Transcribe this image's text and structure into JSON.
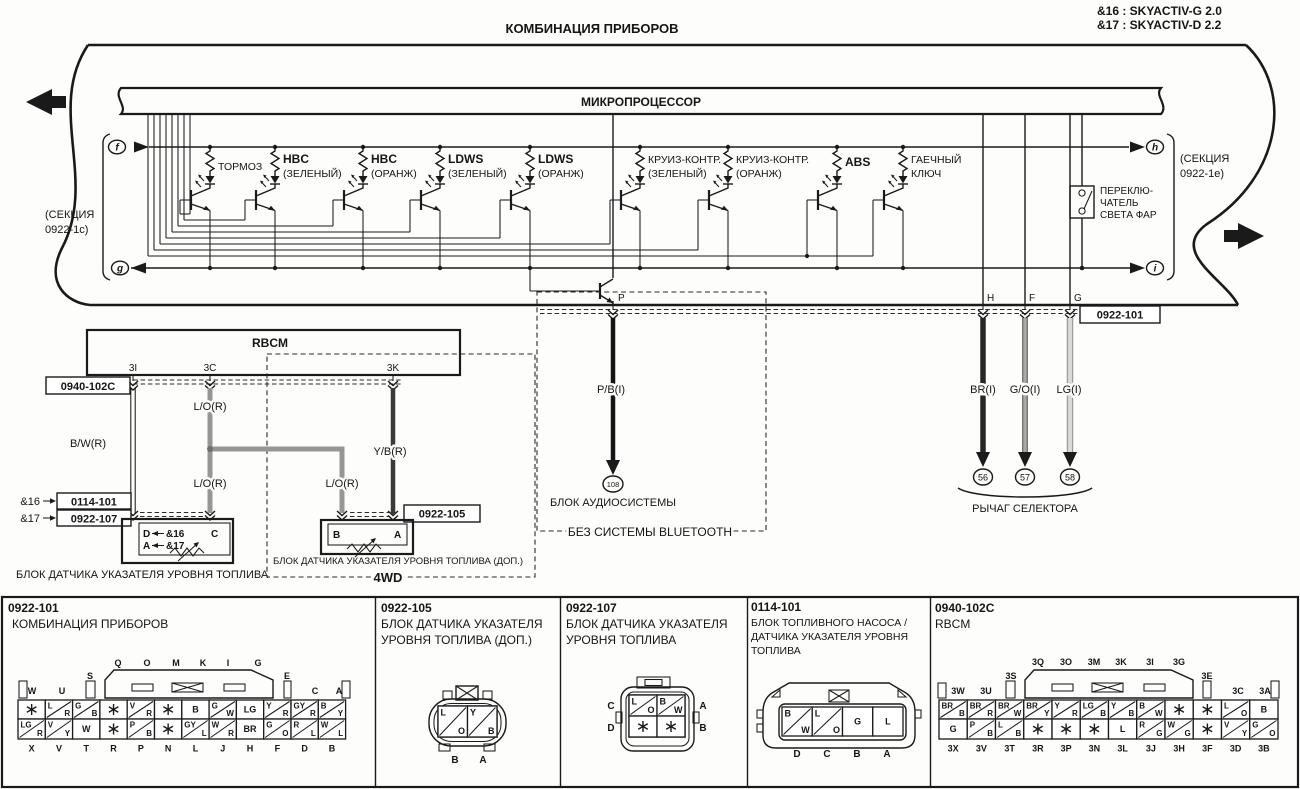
{
  "meta": {
    "variant_notes": [
      "&16 : SKYACTIV-G 2.0",
      "&17 : SKYACTIV-D 2.2"
    ]
  },
  "title": "КОМБИНАЦИЯ ПРИБОРОВ",
  "band": {
    "micro": "МИКРОПРОЦЕССОР",
    "section_left": {
      "l1": "(СЕКЦИЯ",
      "l2": "0922-1c)"
    },
    "section_right": {
      "l1": "(СЕКЦИЯ",
      "l2": "0922-1e)"
    },
    "ports": {
      "f": "f",
      "g": "g",
      "h": "h",
      "i": "i"
    },
    "indicators": [
      {
        "name": "ТОРМОЗ",
        "sub": "",
        "bold": false
      },
      {
        "name": "HBC",
        "sub": "(ЗЕЛЕНЫЙ)",
        "bold": true
      },
      {
        "name": "HBC",
        "sub": "(ОРАНЖ)",
        "bold": true
      },
      {
        "name": "LDWS",
        "sub": "(ЗЕЛЕНЫЙ)",
        "bold": true
      },
      {
        "name": "LDWS",
        "sub": "(ОРАНЖ)",
        "bold": true
      },
      {
        "name": "КРУИЗ-КОНТР.",
        "sub": "(ЗЕЛЕНЫЙ)",
        "bold": false
      },
      {
        "name": "КРУИЗ-КОНТР.",
        "sub": "(ОРАНЖ)",
        "bold": false
      },
      {
        "name": "ABS",
        "sub": "",
        "bold": true
      },
      {
        "name": "ГАЕЧНЫЙ",
        "sub": "КЛЮЧ",
        "bold": false
      }
    ],
    "headlight_switch": {
      "l1": "ПЕРЕКЛЮ-",
      "l2": "ЧАТЕЛЬ",
      "l3": "СВЕТА ФАР"
    },
    "bottom_pins": [
      "P",
      "H",
      "F",
      "G"
    ]
  },
  "rbcm": {
    "title": "RBCM",
    "pins": [
      "3I",
      "3C",
      "3K"
    ],
    "connector_ref": "0940-102C"
  },
  "wires": {
    "bw": "B/W(R)",
    "lo": "L/O(R)",
    "yb": "Y/B(R)",
    "pb": "P/B(I)",
    "br": "BR(I)",
    "go": "G/O(I)",
    "lg": "LG(I)"
  },
  "refs": {
    "amp16": "&16",
    "amp17": "&17",
    "ref16": "0114-101",
    "ref17": "0922-107"
  },
  "sender1": {
    "label": "БЛОК ДАТЧИКА УКАЗАТЕЛЯ УРОВНЯ ТОПЛИВА",
    "pin_d": "D",
    "pin_a": "A",
    "pin_c": "C"
  },
  "sender2": {
    "label": "БЛОК ДАТЧИКА УКАЗАТЕЛЯ УРОВНЯ ТОПЛИВА (ДОП.)",
    "connector_ref": "0922-105",
    "pin_b": "B",
    "pin_a": "A",
    "group": "4WD"
  },
  "audio": {
    "label": "БЛОК АУДИОСИСТЕМЫ",
    "terminal": "108",
    "note": "БЕЗ СИСТЕМЫ BLUETOOTH"
  },
  "selector": {
    "label": "РЫЧАГ СЕЛЕКТОРА",
    "terminals": [
      "56",
      "57",
      "58"
    ],
    "connector_ref": "0922-101"
  },
  "panels": [
    {
      "id": "0922-101",
      "name": [
        "КОМБИНАЦИЯ ПРИБОРОВ"
      ],
      "top_letters": [
        "W",
        "U",
        "S"
      ],
      "housing_letters": [
        "Q",
        "O",
        "M",
        "K",
        "I",
        "G"
      ],
      "right_letters": [
        "E",
        "C",
        "A"
      ],
      "row1": [
        "*",
        "L|R",
        "G|B",
        "*",
        "V|R",
        "*",
        "B",
        "G|W",
        "LG",
        "Y|R",
        "GY|R",
        "B|Y"
      ],
      "row2": [
        "LG|R",
        "V|Y",
        "W",
        "*",
        "P|B",
        "*",
        "GY|L",
        "W|R",
        "BR",
        "G|O",
        "R|L",
        "W|L"
      ],
      "bottom_letters": [
        "X",
        "V",
        "T",
        "R",
        "P",
        "N",
        "L",
        "J",
        "H",
        "F",
        "D",
        "B"
      ]
    },
    {
      "id": "0922-105",
      "name": [
        "БЛОК ДАТЧИКА УКАЗАТЕЛЯ",
        "УРОВНЯ ТОПЛИВА (ДОП.)"
      ],
      "cells": [
        "L|O",
        "Y|B"
      ],
      "pin_letters": [
        "B",
        "A"
      ]
    },
    {
      "id": "0922-107",
      "name": [
        "БЛОК ДАТЧИКА УКАЗАТЕЛЯ",
        "УРОВНЯ ТОПЛИВА"
      ],
      "cells_top": [
        "L|O",
        "B|W"
      ],
      "cells_bottom": [
        "*",
        "*"
      ],
      "left_letters": [
        "C",
        "D"
      ],
      "right_letters": [
        "A",
        "B"
      ]
    },
    {
      "id": "0114-101",
      "name": [
        "БЛОК ТОПЛИВНОГО НАСОСА /",
        "ДАТЧИКА УКАЗАТЕЛЯ УРОВНЯ",
        "ТОПЛИВА"
      ],
      "cells": [
        "B|W",
        "L|O",
        "G",
        "L"
      ],
      "pin_letters": [
        "D",
        "C",
        "B",
        "A"
      ]
    },
    {
      "id": "0940-102C",
      "name": [
        "RBCM"
      ],
      "top_letters": [
        "3W",
        "3U",
        "3S"
      ],
      "housing_letters": [
        "3Q",
        "3O",
        "3M",
        "3K",
        "3I",
        "3G"
      ],
      "right_letters": [
        "3E",
        "3C",
        "3A"
      ],
      "row1": [
        "BR|B",
        "BR|R",
        "BR|W",
        "BR|Y",
        "Y|R",
        "LG|B",
        "Y|B",
        "B|W",
        "*",
        "*",
        "L|O",
        "B"
      ],
      "row2": [
        "G",
        "P|B",
        "L|B",
        "*",
        "*",
        "*",
        "L",
        "R|G",
        "W|G",
        "*",
        "V|Y",
        "G|O"
      ],
      "bottom_letters": [
        "3X",
        "3V",
        "3T",
        "3R",
        "3P",
        "3N",
        "3L",
        "3J",
        "3H",
        "3F",
        "3D",
        "3B"
      ]
    }
  ]
}
